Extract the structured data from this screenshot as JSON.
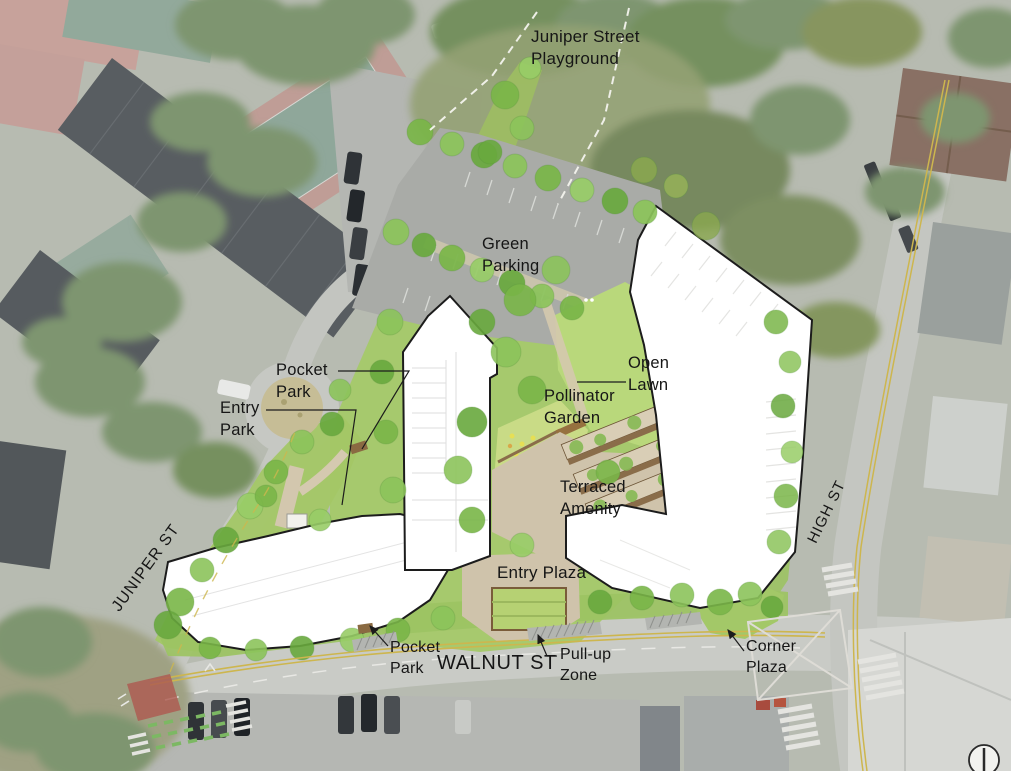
{
  "labels": {
    "playground": "Juniper Street\nPlayground",
    "green_parking": "Green\nParking",
    "pocket_park_upper": "Pocket\nPark",
    "entry_park": "Entry\nPark",
    "open_lawn": "Open\nLawn",
    "pollinator_garden": "Pollinator\nGarden",
    "terraced_amenity": "Terraced\nAmenity",
    "entry_plaza": "Entry Plaza",
    "pocket_park_lower": "Pocket\nPark",
    "walnut_st": "WALNUT ST",
    "pull_up_zone": "Pull-up\nZone",
    "corner_plaza": "Corner\nPlaza",
    "juniper_st": "JUNIPER ST",
    "high_st": "HIGH ST"
  },
  "icons": {
    "north_indicator": "north-arrow-icon"
  },
  "colors": {
    "site_green": "#a6c96a",
    "lawn_green": "#b9d87b",
    "tree_green": "#7ab648",
    "paving_tan": "#cfc3ab",
    "parking_gray": "#a9aba7",
    "building_white": "#ffffff",
    "outline_black": "#1c1c1c",
    "road_gray": "#c6c8c3",
    "marking_yellow": "#cdb64e",
    "terrace_brown": "#8a6d4a",
    "pollinator_yellow": "#e6df55",
    "label_black": "#161616"
  }
}
